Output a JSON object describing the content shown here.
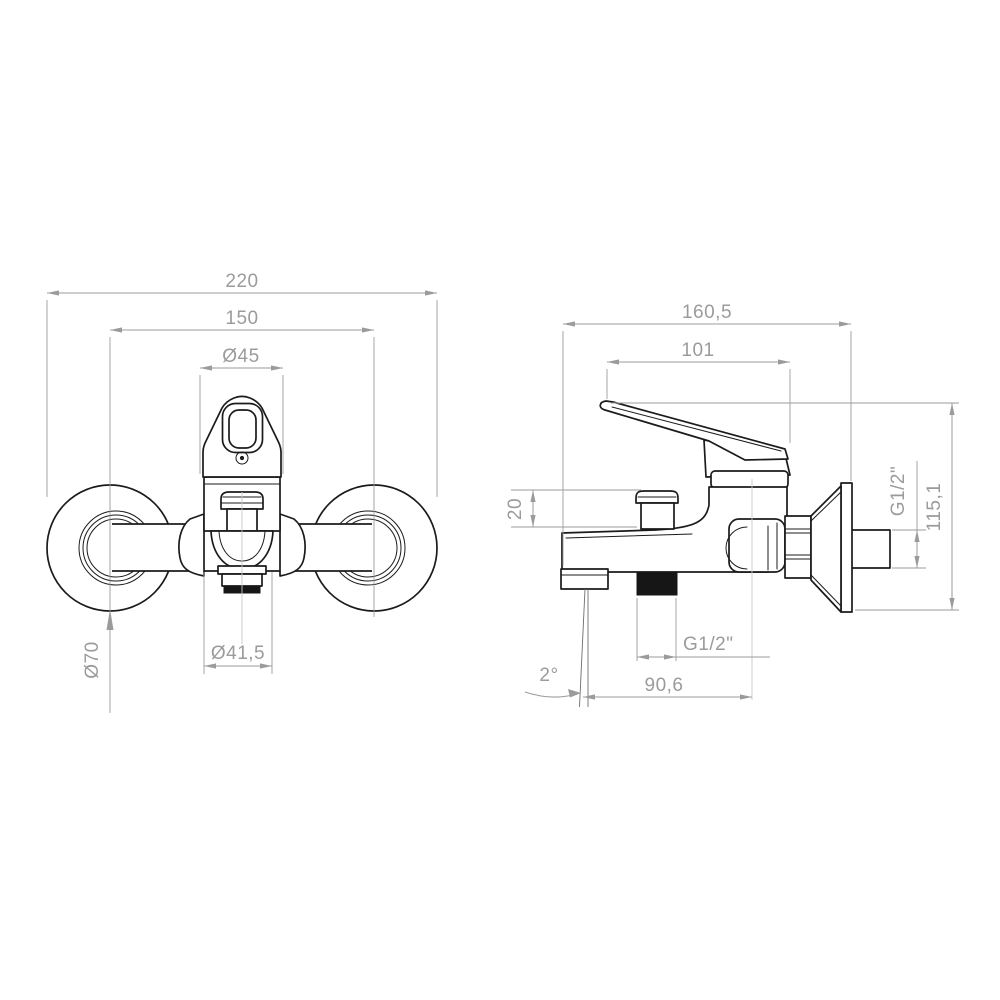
{
  "drawing": {
    "type": "technical-drawing",
    "subject": "wall-mounted bath shower mixer faucet, two orthographic views",
    "colors": {
      "background": "#ffffff",
      "object_line": "#1b1b1b",
      "dimension": "#9b9b9b"
    },
    "front": {
      "view_label": "front-view",
      "dims": {
        "overall_width": "220",
        "mount_centers": "150",
        "cartridge_diameter": "Ø45",
        "escutcheon_diameter": "Ø70",
        "aerator_diameter": "Ø41,5"
      }
    },
    "side": {
      "view_label": "side-view",
      "dims": {
        "overall_depth": "160,5",
        "handle_reach": "101",
        "diverter_height": "20",
        "wall_thread": "G1/2\"",
        "overall_height": "115,1",
        "shower_thread": "G1/2\"",
        "spout_reach": "90,6",
        "spout_angle": "2°"
      }
    }
  }
}
